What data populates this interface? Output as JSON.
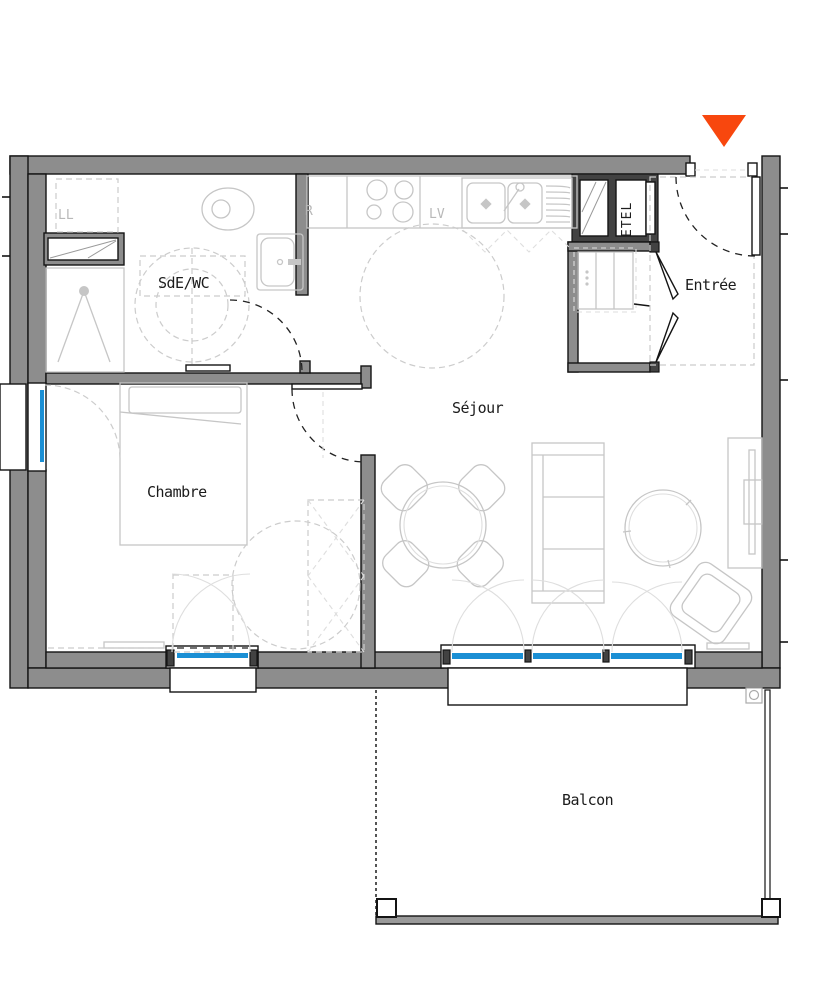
{
  "rooms": [
    {
      "id": "sde_wc",
      "label": "SdE/WC"
    },
    {
      "id": "chambre",
      "label": "Chambre"
    },
    {
      "id": "sejour",
      "label": "Séjour"
    },
    {
      "id": "entree",
      "label": "Entrée"
    },
    {
      "id": "balcon",
      "label": "Balcon"
    }
  ],
  "appliances": {
    "washing_machine": "LL",
    "fridge": "R",
    "dishwasher": "LV",
    "technical_duct": "ETEL"
  },
  "colors": {
    "wall": "#8d8d8d",
    "wall-dark": "#424242",
    "line": "#141414",
    "furniture": "#c6c6c6",
    "dashed": "#cccccc",
    "window-blue": "#1b8fd4",
    "accent": "#f8470e",
    "text": "#1b1b1b",
    "text-muted": "#b8b8b8"
  }
}
